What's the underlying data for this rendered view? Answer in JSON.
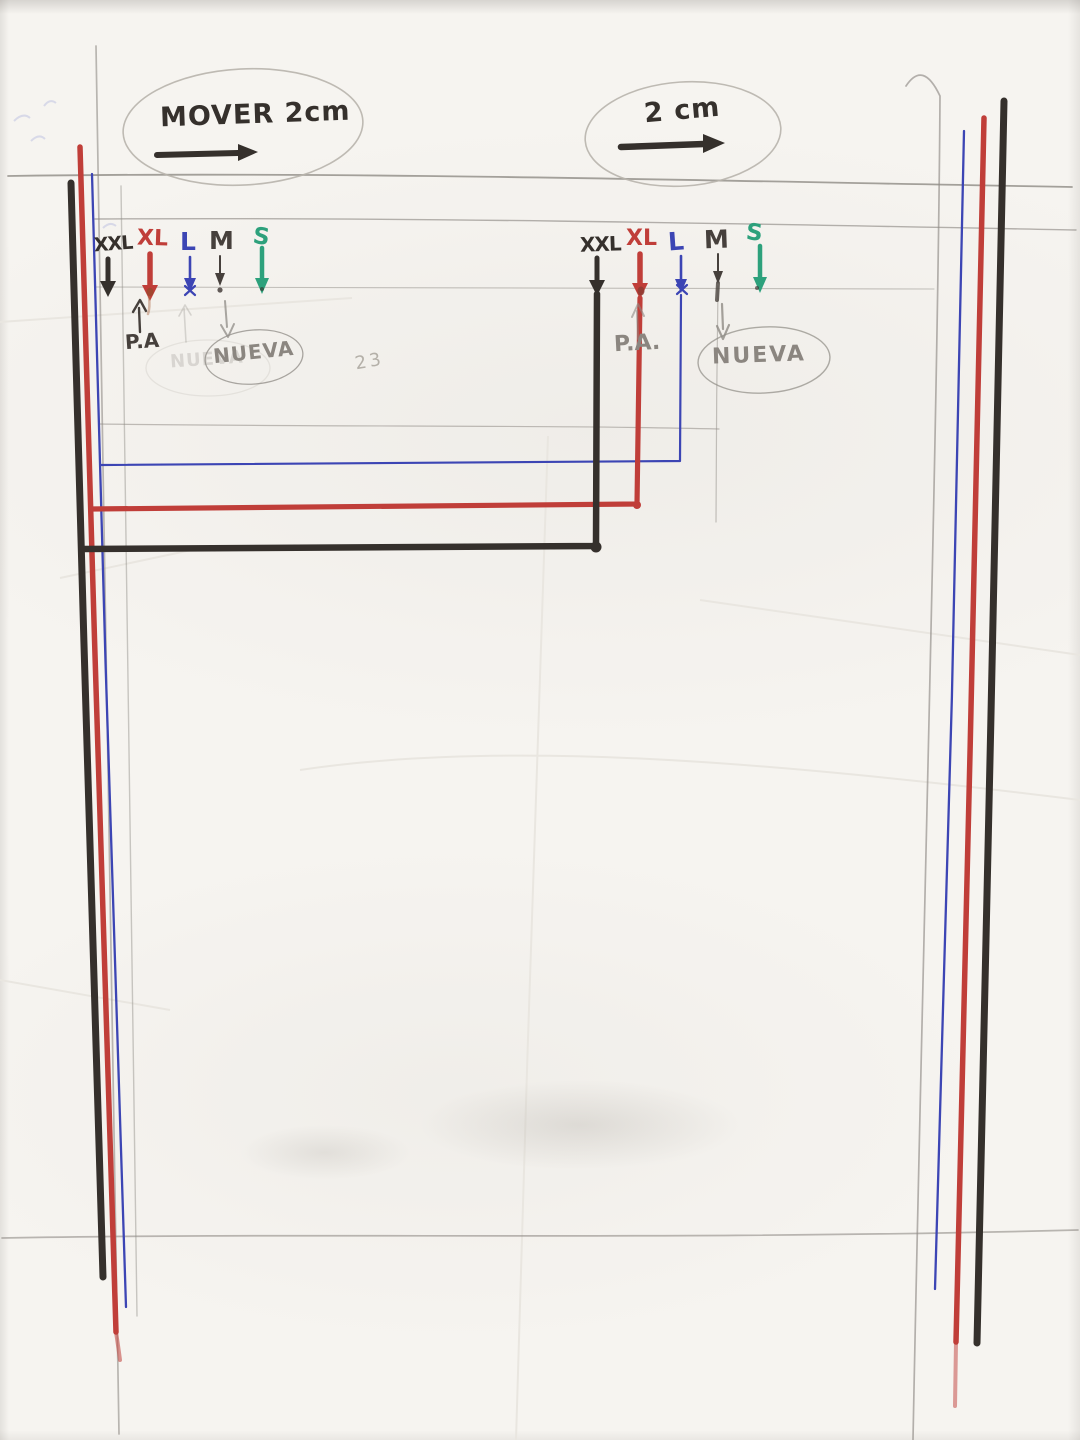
{
  "annotations": {
    "move_left": {
      "label": "MOVER 2cm"
    },
    "move_right": {
      "label": "2 cm"
    },
    "pencil_number": "23"
  },
  "size_scale_left": {
    "sizes": [
      {
        "label": "XXL",
        "color": "#35302c"
      },
      {
        "label": "XL",
        "color": "#c03e39"
      },
      {
        "label": "L",
        "color": "#3c45b4"
      },
      {
        "label": "M",
        "color": "#46403c"
      },
      {
        "label": "S",
        "color": "#2da17c"
      }
    ],
    "pa_label": "P.A",
    "nueva_label": "NUEVA"
  },
  "size_scale_right": {
    "sizes": [
      {
        "label": "XXL",
        "color": "#35302c"
      },
      {
        "label": "XL",
        "color": "#c03e39"
      },
      {
        "label": "L",
        "color": "#3c45b4"
      },
      {
        "label": "M",
        "color": "#46403c"
      },
      {
        "label": "S",
        "color": "#2da17c"
      }
    ],
    "pa_label": "P.A.",
    "nueva_label": "NUEVA"
  },
  "colors": {
    "marker_black": "#35302c",
    "marker_red": "#c03e39",
    "pen_blue": "#3c45b4",
    "marker_green": "#2da17c",
    "pen_dark": "#46403c",
    "pencil": "#8f8b85",
    "pencil_light": "#b8b4ac",
    "paper": "#f6f4f0"
  }
}
